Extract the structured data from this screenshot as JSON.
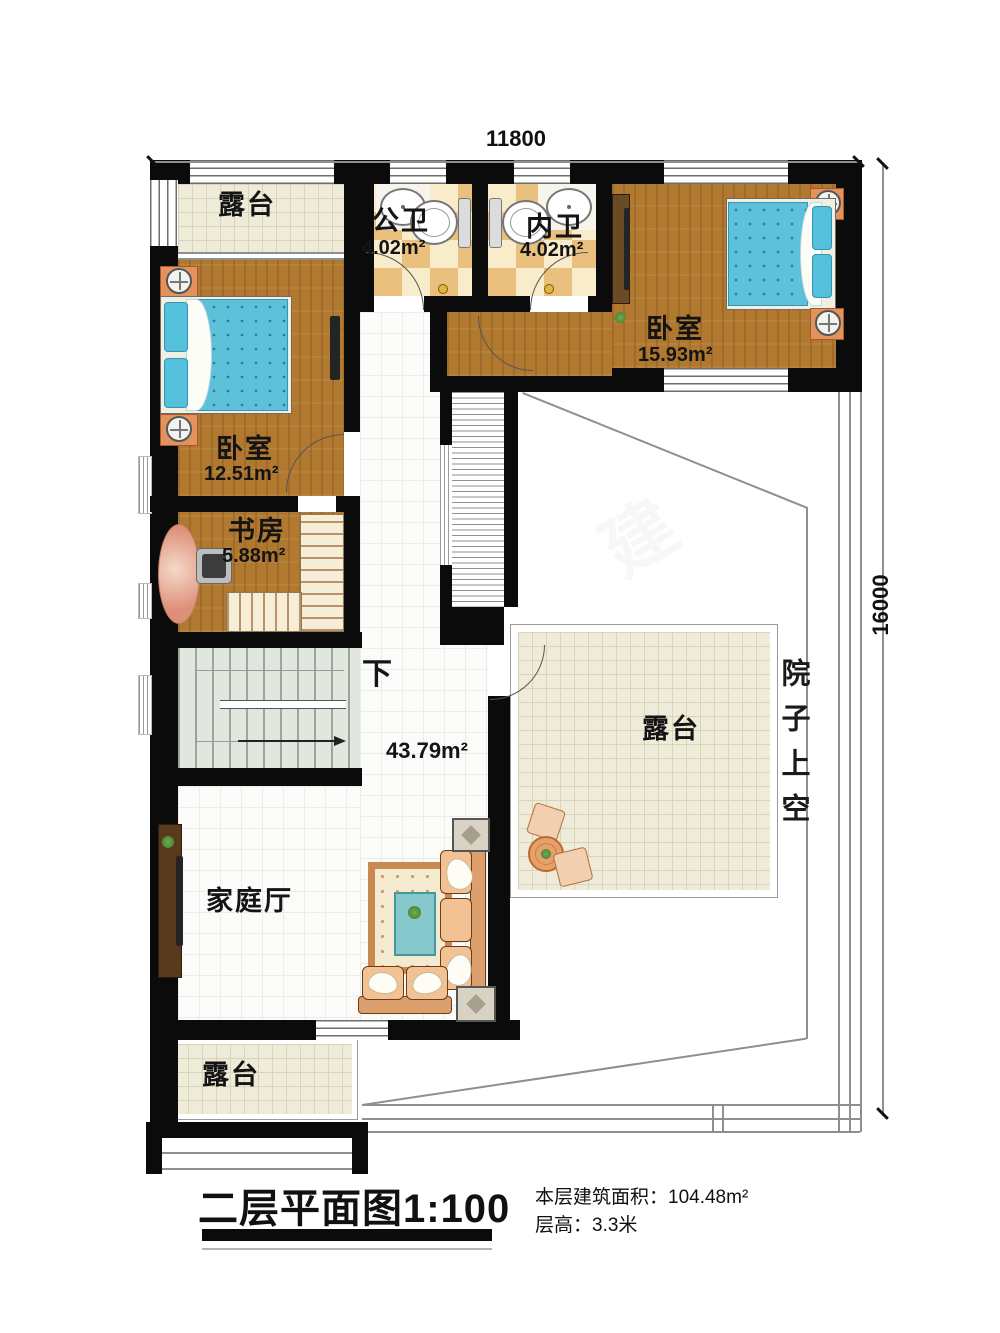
{
  "dimensions": {
    "width_top": "11800",
    "height_right": "16000"
  },
  "rooms": {
    "terrace_top": {
      "name": "露台"
    },
    "public_bath": {
      "name": "公卫",
      "area": "4.02m²"
    },
    "inner_bath": {
      "name": "内卫",
      "area": "4.02m²"
    },
    "bedroom_right": {
      "name": "卧室",
      "area": "15.93m²"
    },
    "bedroom_left": {
      "name": "卧室",
      "area": "12.51m²"
    },
    "study": {
      "name": "书房",
      "area": "5.88m²"
    },
    "hall": {
      "area": "43.79m²",
      "stairs_label": "下"
    },
    "family_room": {
      "name": "家庭厅"
    },
    "terrace_mid": {
      "name": "露台"
    },
    "terrace_bottom": {
      "name": "露台"
    },
    "courtyard": {
      "name": "院子上空"
    }
  },
  "footer": {
    "title": "二层平面图1:100",
    "building_area": "本层建筑面积：104.48m²",
    "floor_height": "层高：3.3米"
  },
  "watermark": {
    "char1": "柏",
    "char2": "建"
  }
}
